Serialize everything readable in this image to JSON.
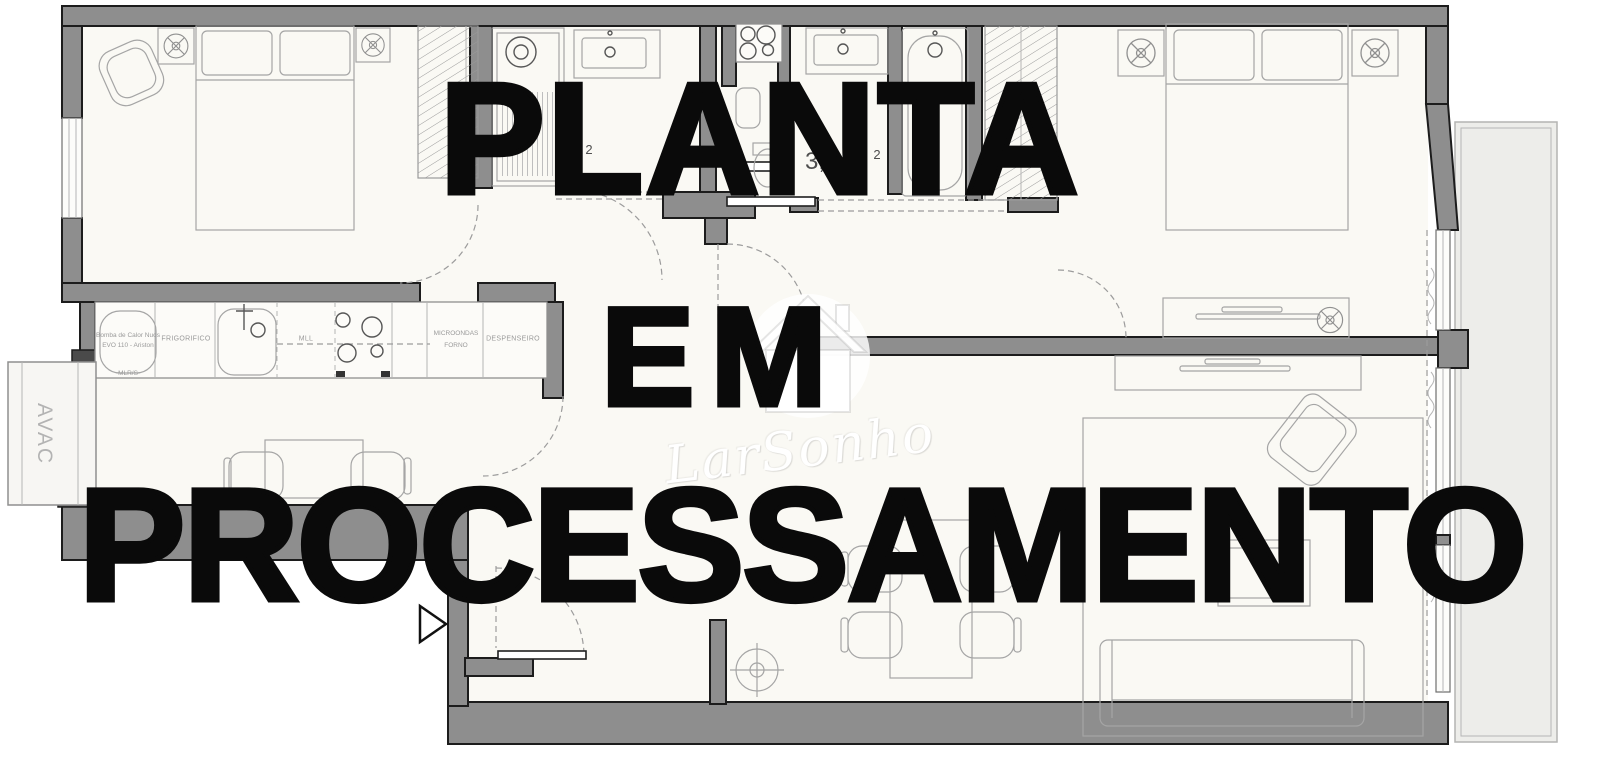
{
  "overlay": {
    "line1": "PLANTA",
    "line2": "EM",
    "line3": "PROCESSAMENTO",
    "color": "#0a0a0a"
  },
  "logo": {
    "name": "LarSonho",
    "color": "#ffffff"
  },
  "plan": {
    "labels": {
      "avac": "AVAC",
      "heat_pump_line1": "Bomba de Calor Nuos",
      "heat_pump_line2": "EVO 110 - Ariston",
      "fridge": "FRIGORIFICO",
      "dishwasher": "MLL",
      "washer": "MLR/S",
      "microwave_line1": "MICROONDAS",
      "microwave_line2": "FORNO",
      "pantry": "DESPENSEIRO",
      "area_fragment": "3,",
      "area_sup_right": "2",
      "area_sup_left": "2"
    },
    "colors": {
      "wall_fill": "#8e8e8e",
      "wall_edge": "#1c1c1c",
      "room_fill": "#faf9f4",
      "furniture_stroke": "#a5a5a5",
      "balcony_fill": "#ededea"
    }
  }
}
